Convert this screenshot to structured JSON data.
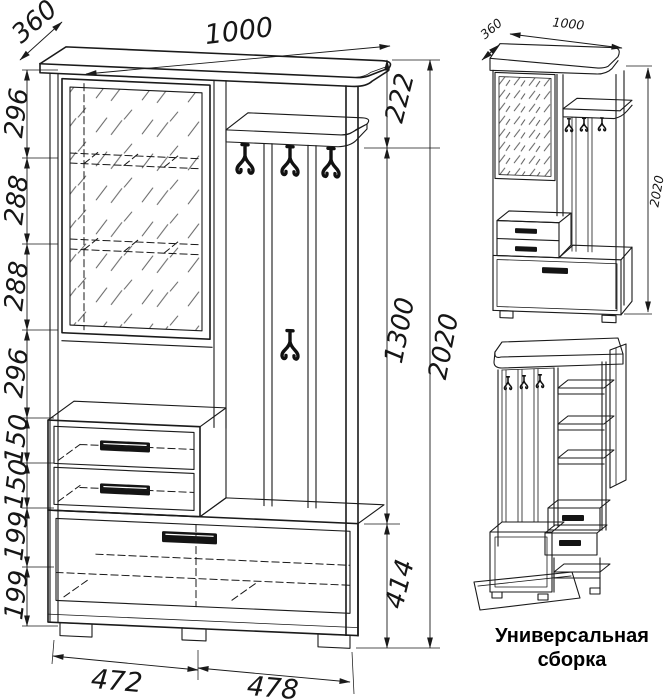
{
  "main_view": {
    "top_width": "1000",
    "depth": "360",
    "left_heights": [
      "296",
      "288",
      "288",
      "296",
      "150",
      "150",
      "199",
      "199"
    ],
    "right_heights": [
      "222",
      "1300",
      "414"
    ],
    "total_height": "2020",
    "bottom_widths": [
      "472",
      "478"
    ]
  },
  "assembled_view": {
    "depth": "360",
    "width": "1000",
    "height": "2020"
  },
  "universal_view": {
    "caption_line1": "Универсальная",
    "caption_line2": "сборка"
  }
}
